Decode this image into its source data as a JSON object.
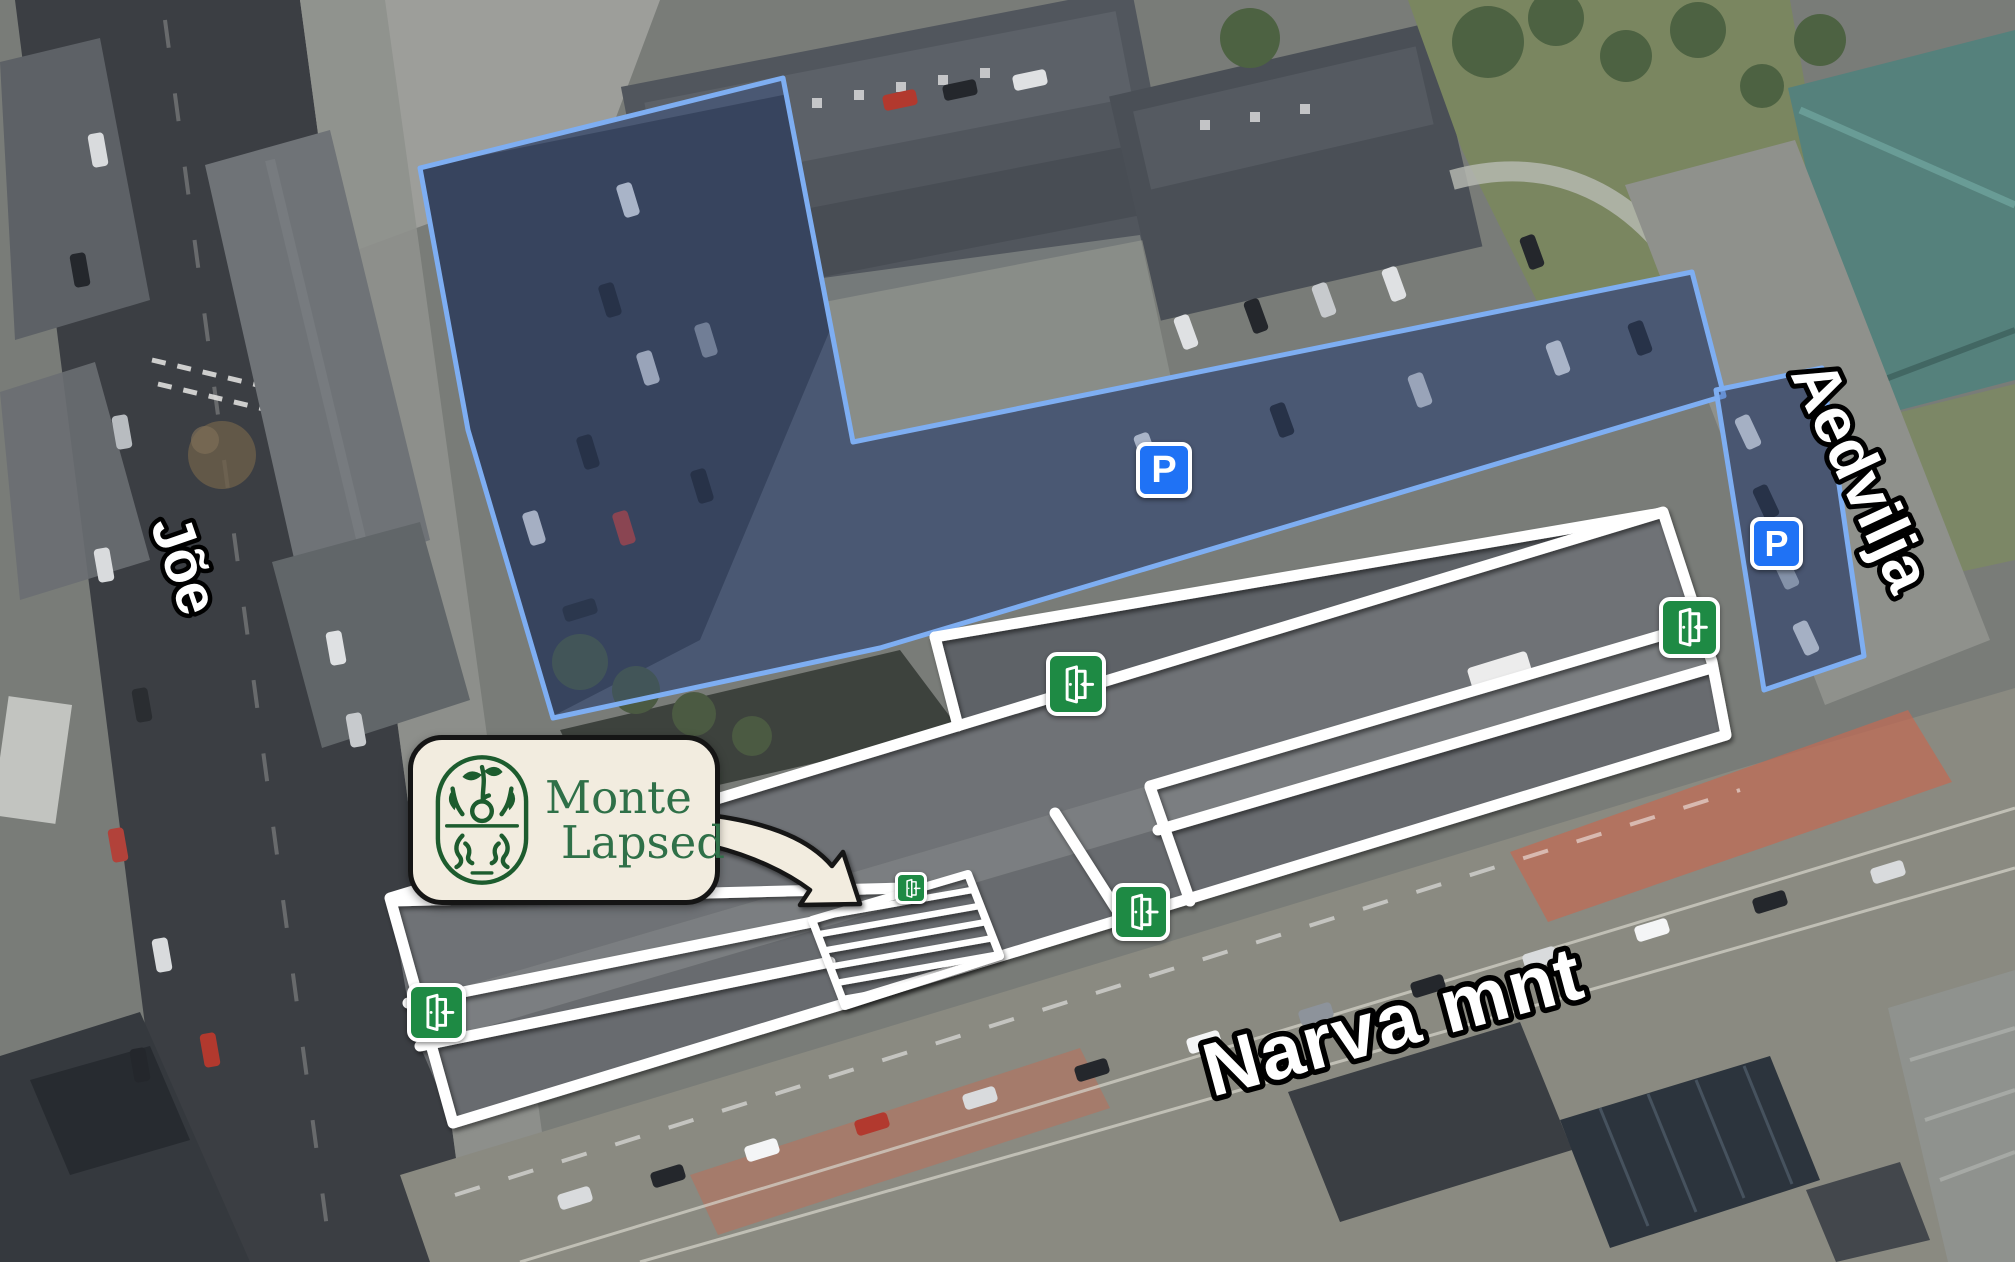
{
  "map_overlay": {
    "street_labels": {
      "joe": "Jõe",
      "aedvilja": "Aedvilja",
      "narva_mnt": "Narva mnt"
    },
    "logo": {
      "line1": "Monte",
      "line2": "Lapsed"
    },
    "parking_badge_letter": "P",
    "icons": {
      "parking_icon": "blue-rounded-square-white-P",
      "entrance_door_icon": "green-rounded-square-open-door-with-arrow"
    },
    "counts": {
      "parking_icons": 2,
      "entrance_door_icons": 5
    },
    "colors": {
      "parking_area_outline": "#7EAEF2",
      "parking_badge_blue": "#1F72F5",
      "entrance_green": "#1E8A44",
      "building_outline": "#FFFFFF",
      "hatched_area_stripes": "#FFFFFF",
      "logo_background": "#F2ECDF",
      "logo_border": "#151515",
      "logo_green": "#2F7048",
      "street_label_fill": "#FFFFFF",
      "street_label_outline": "#000000"
    }
  }
}
